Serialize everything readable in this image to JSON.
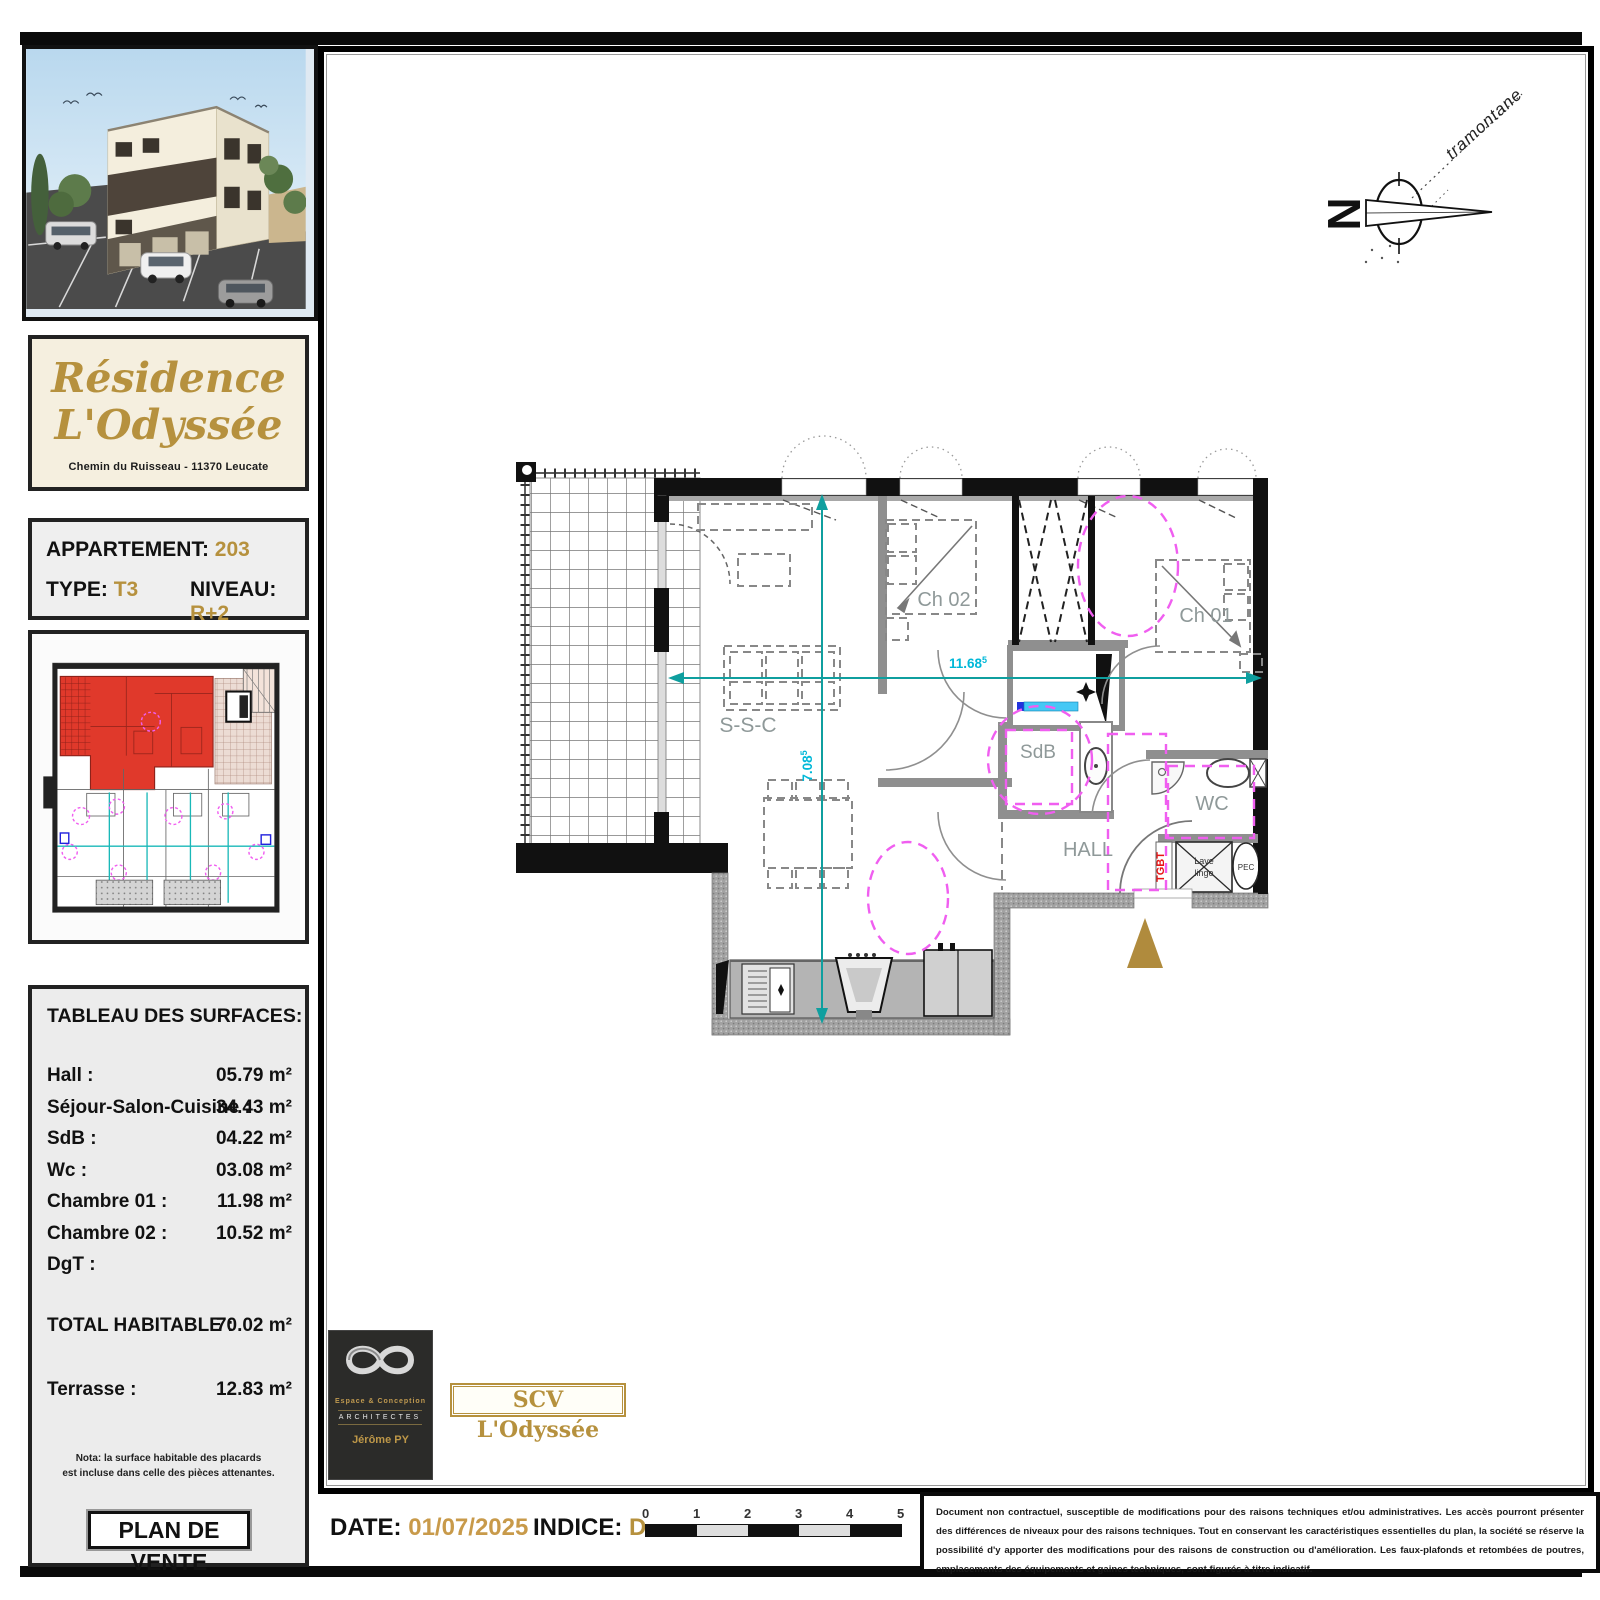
{
  "sidebar": {
    "residence": {
      "title_line1": "Résidence",
      "title_line2": "L'Odyssée",
      "address": "Chemin du Ruisseau - 11370 Leucate"
    },
    "apartment": {
      "label_apartment": "APPARTEMENT:",
      "number": "203",
      "label_type": "TYPE:",
      "type": "T3",
      "label_level": "NIVEAU:",
      "level": "R+2"
    },
    "surfaces": {
      "title": "TABLEAU DES SURFACES:",
      "rows": [
        {
          "label": "Hall :",
          "value": "05.79 m²"
        },
        {
          "label": "Séjour-Salon-Cuisine :",
          "value": "34.43 m²"
        },
        {
          "label": "SdB :",
          "value": "04.22 m²"
        },
        {
          "label": "Wc :",
          "value": "03.08 m²"
        },
        {
          "label": "Chambre 01 :",
          "value": "11.98 m²"
        },
        {
          "label": "Chambre 02 :",
          "value": "10.52 m²"
        },
        {
          "label": "DgT :",
          "value": ""
        }
      ],
      "total_label": "TOTAL HABITABLE :",
      "total_value": "70.02 m²",
      "terrace_label": "Terrasse :",
      "terrace_value": "12.83 m²",
      "nota_line1": "Nota: la surface habitable des placards",
      "nota_line2": "est incluse dans celle des pièces attenantes.",
      "plan_de_vente": "PLAN DE VENTE"
    }
  },
  "plan": {
    "labels": {
      "living": "S-S-C",
      "bedroom2": "Ch 02",
      "bedroom1": "Ch 01",
      "bathroom": "SdB",
      "wc": "WC",
      "hall": "HALL",
      "tgbt": "TGBT",
      "washer_line1": "Lave",
      "washer_line2": "linge",
      "water_heater": "PEC"
    },
    "dimensions": {
      "width": "11.68",
      "width_sup": "5",
      "height": "7.08",
      "height_sup": "5"
    },
    "compass": {
      "north_letter": "N",
      "wind_label": "tramontane"
    }
  },
  "footer": {
    "architect": {
      "studio_line1": "Espace & Conception",
      "studio_line2": "ARCHITECTES",
      "studio_line3": "Jérôme PY"
    },
    "developer": "SCV L'Odyssée",
    "date_label": "DATE:",
    "date_value": "01/07/2025",
    "indice_label": "INDICE:",
    "indice_value": "D",
    "scale_ticks": [
      "0",
      "1",
      "2",
      "3",
      "4",
      "5"
    ],
    "disclaimer": "Document non contractuel, susceptible de modifications pour des raisons techniques et/ou administratives. Les accès pourront présenter des différences de niveaux pour des raisons techniques. Tout en conservant les caractéristiques essentielles du plan, la société se réserve la possibilité d'y apporter des modifications pour des raisons de construction ou d'amélioration. Les faux-plafonds et retombées de poutres, emplacements des équipements et gaines techniques, sont figurés à titre indicatif."
  },
  "colors": {
    "gold": "#b6913e",
    "magenta": "#f05ef0",
    "teal_dimension": "#0f9f9f",
    "cyan_dim_text": "#00b8d8",
    "tgbt_red": "#e81515",
    "highlight_apartment_red": "#e0392b"
  }
}
